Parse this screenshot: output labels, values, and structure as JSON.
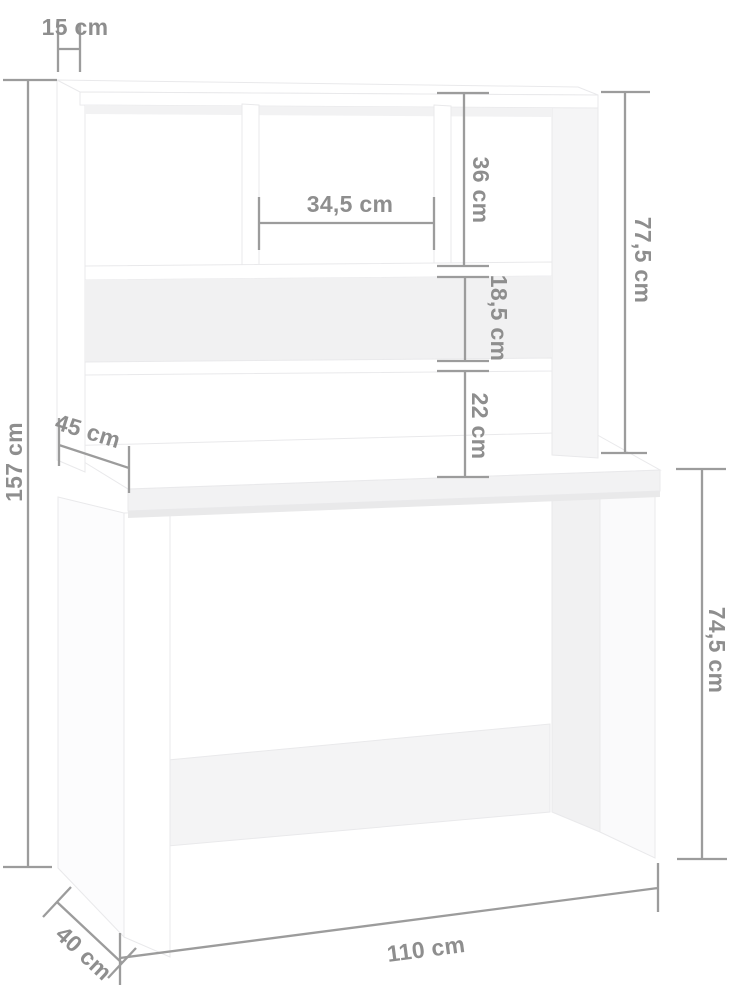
{
  "diagram": {
    "type": "furniture-dimension-diagram",
    "subject": "desk with shelf hutch",
    "unit": "cm",
    "dimensions": {
      "top_depth": "15 cm",
      "total_height": "157 cm",
      "middle_cubby_width": "34,5 cm",
      "upper_cubby_height": "36 cm",
      "hutch_height": "77,5 cm",
      "shelf_slot_height": "18,5 cm",
      "shelf_to_desktop_gap": "22 cm",
      "desktop_depth": "45 cm",
      "desk_height": "74,5 cm",
      "desk_width": "110 cm",
      "desk_base_depth": "40 cm"
    },
    "colors": {
      "background": "#ffffff",
      "furniture_fill": "#ffffff",
      "furniture_shade": "#f1f1f2",
      "furniture_outline": "#e9e9eb",
      "dimension_line": "#9c9c9c",
      "dimension_text": "#8e8e8e"
    }
  }
}
